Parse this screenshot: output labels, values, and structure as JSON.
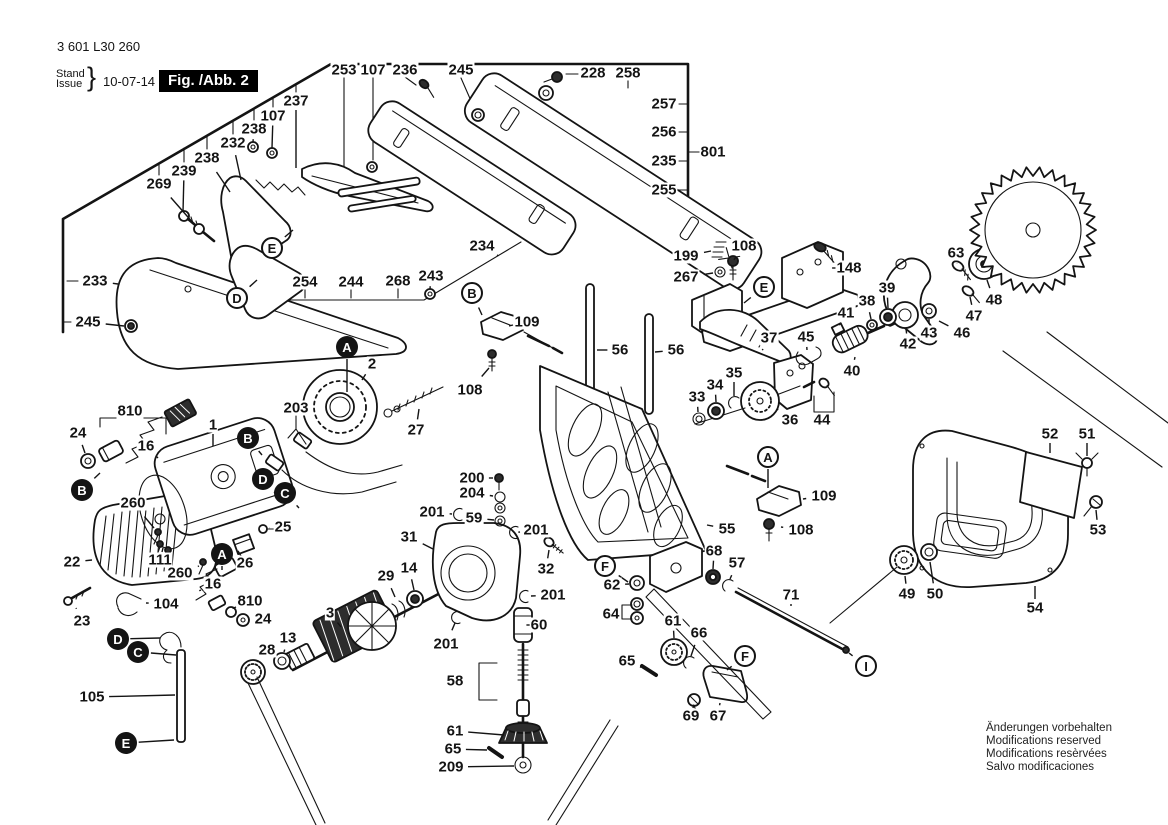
{
  "header": {
    "part_number": "3 601 L30 260",
    "stand_label": "Stand",
    "issue_label": "Issue",
    "brace": "}",
    "date": "10-07-14",
    "figure_label": "Fig. /Abb. 2"
  },
  "footer": {
    "lines": [
      "Änderungen vorbehalten",
      "Modifications reserved",
      "Modifications resèrvées",
      "Salvo modificaciones"
    ]
  },
  "colors": {
    "ink": "#141414",
    "paper": "#ffffff",
    "figure_box_bg": "#000000",
    "figure_box_text": "#ffffff"
  },
  "diagram": {
    "blade": {
      "cx": 1033,
      "cy": 230,
      "r_outer": 63,
      "r_inner": 54,
      "teeth": 30
    }
  },
  "part_labels": [
    {
      "t": "253",
      "x": 344,
      "y": 70
    },
    {
      "t": "107",
      "x": 373,
      "y": 70
    },
    {
      "t": "236",
      "x": 405,
      "y": 70
    },
    {
      "t": "245",
      "x": 461,
      "y": 70
    },
    {
      "t": "228",
      "x": 593,
      "y": 73
    },
    {
      "t": "258",
      "x": 628,
      "y": 73
    },
    {
      "t": "257",
      "x": 664,
      "y": 104
    },
    {
      "t": "256",
      "x": 664,
      "y": 132
    },
    {
      "t": "801",
      "x": 713,
      "y": 152
    },
    {
      "t": "235",
      "x": 664,
      "y": 161
    },
    {
      "t": "255",
      "x": 664,
      "y": 190
    },
    {
      "t": "237",
      "x": 296,
      "y": 101,
      "lx": 296,
      "ly": 168
    },
    {
      "t": "107",
      "x": 273,
      "y": 116,
      "lx": 272,
      "ly": 148
    },
    {
      "t": "238",
      "x": 254,
      "y": 129,
      "lx": 253,
      "ly": 142
    },
    {
      "t": "232",
      "x": 233,
      "y": 143,
      "lx": 241,
      "ly": 180
    },
    {
      "t": "238",
      "x": 207,
      "y": 158,
      "lx": 230,
      "ly": 192
    },
    {
      "t": "239",
      "x": 184,
      "y": 171,
      "lx": 183,
      "ly": 212
    },
    {
      "t": "269",
      "x": 159,
      "y": 184,
      "lx": 194,
      "ly": 224
    },
    {
      "t": "233",
      "x": 95,
      "y": 281,
      "lx": 118,
      "ly": 284
    },
    {
      "t": "245",
      "x": 88,
      "y": 322,
      "lx": 124,
      "ly": 326
    },
    {
      "t": "254",
      "x": 305,
      "y": 282
    },
    {
      "t": "244",
      "x": 351,
      "y": 282
    },
    {
      "t": "268",
      "x": 398,
      "y": 281
    },
    {
      "t": "243",
      "x": 431,
      "y": 276,
      "lx": 430,
      "ly": 289
    },
    {
      "t": "234",
      "x": 482,
      "y": 246,
      "lx": 497,
      "ly": 255
    },
    {
      "t": "109",
      "x": 527,
      "y": 322,
      "lx": 513,
      "ly": 325
    },
    {
      "t": "108",
      "x": 470,
      "y": 390,
      "lx": 489,
      "ly": 368
    },
    {
      "t": "56",
      "x": 620,
      "y": 350,
      "lx": 597,
      "ly": 350
    },
    {
      "t": "56",
      "x": 676,
      "y": 350,
      "lx": 655,
      "ly": 352
    },
    {
      "t": "199",
      "x": 686,
      "y": 256,
      "lx": 711,
      "ly": 251
    },
    {
      "t": "108",
      "x": 744,
      "y": 246,
      "lx": 736,
      "ly": 257
    },
    {
      "t": "267",
      "x": 686,
      "y": 277,
      "lx": 713,
      "ly": 273
    },
    {
      "t": "148",
      "x": 849,
      "y": 268,
      "lx": 845,
      "ly": 268
    },
    {
      "t": "63",
      "x": 956,
      "y": 253,
      "lx": 957,
      "ly": 263
    },
    {
      "t": "39",
      "x": 887,
      "y": 288,
      "lx": 888,
      "ly": 308
    },
    {
      "t": "38",
      "x": 867,
      "y": 301,
      "lx": 871,
      "ly": 319
    },
    {
      "t": "41",
      "x": 846,
      "y": 313,
      "lx": 840,
      "ly": 324
    },
    {
      "t": "48",
      "x": 994,
      "y": 300,
      "lx": 987,
      "ly": 280
    },
    {
      "t": "47",
      "x": 974,
      "y": 316,
      "lx": 970,
      "ly": 297
    },
    {
      "t": "46",
      "x": 962,
      "y": 333,
      "lx": 939,
      "ly": 321
    },
    {
      "t": "43",
      "x": 929,
      "y": 333,
      "lx": 929,
      "ly": 319
    },
    {
      "t": "42",
      "x": 908,
      "y": 344,
      "lx": 906,
      "ly": 329
    },
    {
      "t": "37",
      "x": 769,
      "y": 338,
      "lx": 763,
      "ly": 349
    },
    {
      "t": "45",
      "x": 806,
      "y": 337,
      "lx": 807,
      "ly": 350
    },
    {
      "t": "40",
      "x": 852,
      "y": 371,
      "lx": 855,
      "ly": 357
    },
    {
      "t": "35",
      "x": 734,
      "y": 373,
      "lx": 734,
      "ly": 396
    },
    {
      "t": "34",
      "x": 715,
      "y": 385,
      "lx": 716,
      "ly": 402
    },
    {
      "t": "33",
      "x": 697,
      "y": 397,
      "lx": 698,
      "ly": 412
    },
    {
      "t": "36",
      "x": 790,
      "y": 420,
      "lx": 777,
      "ly": 409
    },
    {
      "t": "44",
      "x": 822,
      "y": 420
    },
    {
      "t": "2",
      "x": 372,
      "y": 364,
      "lx": 362,
      "ly": 380
    },
    {
      "t": "203",
      "x": 296,
      "y": 408
    },
    {
      "t": "1",
      "x": 213,
      "y": 425,
      "lx": 213,
      "ly": 446
    },
    {
      "t": "27",
      "x": 416,
      "y": 430,
      "lx": 419,
      "ly": 409
    },
    {
      "t": "810",
      "x": 130,
      "y": 411
    },
    {
      "t": "24",
      "x": 78,
      "y": 433,
      "lx": 85,
      "ly": 453
    },
    {
      "t": "16",
      "x": 146,
      "y": 446,
      "lx": 158,
      "ly": 458
    },
    {
      "t": "260",
      "x": 133,
      "y": 503,
      "lx": 154,
      "ly": 528
    },
    {
      "t": "25",
      "x": 283,
      "y": 527,
      "lx": 270,
      "ly": 528
    },
    {
      "t": "26",
      "x": 245,
      "y": 563,
      "lx": 241,
      "ly": 556
    },
    {
      "t": "22",
      "x": 72,
      "y": 562,
      "lx": 92,
      "ly": 560
    },
    {
      "t": "111",
      "x": 160,
      "y": 560,
      "lx": 162,
      "ly": 552
    },
    {
      "t": "260",
      "x": 180,
      "y": 573,
      "lx": 199,
      "ly": 566
    },
    {
      "t": "23",
      "x": 82,
      "y": 621,
      "lx": 76,
      "ly": 608
    },
    {
      "t": "104",
      "x": 166,
      "y": 604,
      "lx": 146,
      "ly": 603
    },
    {
      "t": "16",
      "x": 213,
      "y": 584,
      "lx": 201,
      "ly": 590
    },
    {
      "t": "810",
      "x": 250,
      "y": 601,
      "lx": 236,
      "ly": 607
    },
    {
      "t": "24",
      "x": 263,
      "y": 619,
      "lx": 250,
      "ly": 620
    },
    {
      "t": "105",
      "x": 92,
      "y": 697,
      "lx": 175,
      "ly": 695
    },
    {
      "t": "28",
      "x": 267,
      "y": 650,
      "lx": 257,
      "ly": 662
    },
    {
      "t": "13",
      "x": 288,
      "y": 638,
      "lx": 284,
      "ly": 652
    },
    {
      "t": "3",
      "x": 330,
      "y": 613,
      "lx": 341,
      "ly": 627
    },
    {
      "t": "29",
      "x": 386,
      "y": 576,
      "lx": 395,
      "ly": 597
    },
    {
      "t": "14",
      "x": 409,
      "y": 568,
      "lx": 414,
      "ly": 590
    },
    {
      "t": "31",
      "x": 409,
      "y": 537,
      "lx": 433,
      "ly": 549
    },
    {
      "t": "200",
      "x": 472,
      "y": 478,
      "lx": 493,
      "ly": 478
    },
    {
      "t": "204",
      "x": 472,
      "y": 493,
      "lx": 493,
      "ly": 496
    },
    {
      "t": "201",
      "x": 432,
      "y": 512,
      "lx": 452,
      "ly": 514
    },
    {
      "t": "59",
      "x": 474,
      "y": 518,
      "lx": 494,
      "ly": 520
    },
    {
      "t": "201",
      "x": 536,
      "y": 530,
      "lx": 520,
      "ly": 532
    },
    {
      "t": "32",
      "x": 546,
      "y": 569,
      "lx": 549,
      "ly": 550
    },
    {
      "t": "201",
      "x": 553,
      "y": 595,
      "lx": 531,
      "ly": 596
    },
    {
      "t": "201",
      "x": 446,
      "y": 644,
      "lx": 455,
      "ly": 623
    },
    {
      "t": "60",
      "x": 539,
      "y": 625,
      "lx": 533,
      "ly": 625
    },
    {
      "t": "58",
      "x": 455,
      "y": 681
    },
    {
      "t": "61",
      "x": 455,
      "y": 731,
      "lx": 504,
      "ly": 735
    },
    {
      "t": "65",
      "x": 453,
      "y": 749,
      "lx": 487,
      "ly": 750
    },
    {
      "t": "209",
      "x": 451,
      "y": 767,
      "lx": 514,
      "ly": 766
    },
    {
      "t": "55",
      "x": 727,
      "y": 529,
      "lx": 707,
      "ly": 525
    },
    {
      "t": "68",
      "x": 714,
      "y": 551,
      "lx": 713,
      "ly": 569
    },
    {
      "t": "57",
      "x": 737,
      "y": 563,
      "lx": 730,
      "ly": 579
    },
    {
      "t": "109",
      "x": 824,
      "y": 496,
      "lx": 803,
      "ly": 499
    },
    {
      "t": "108",
      "x": 801,
      "y": 530,
      "lx": 781,
      "ly": 527
    },
    {
      "t": "62",
      "x": 612,
      "y": 585,
      "lx": 629,
      "ly": 584
    },
    {
      "t": "64",
      "x": 611,
      "y": 614
    },
    {
      "t": "61",
      "x": 673,
      "y": 621,
      "lx": 674,
      "ly": 638
    },
    {
      "t": "66",
      "x": 699,
      "y": 633,
      "lx": 691,
      "ly": 656
    },
    {
      "t": "65",
      "x": 627,
      "y": 661,
      "lx": 640,
      "ly": 667
    },
    {
      "t": "69",
      "x": 691,
      "y": 716,
      "lx": 693,
      "ly": 708
    },
    {
      "t": "67",
      "x": 718,
      "y": 716,
      "lx": 720,
      "ly": 703
    },
    {
      "t": "71",
      "x": 791,
      "y": 595,
      "lx": 791,
      "ly": 606
    },
    {
      "t": "52",
      "x": 1050,
      "y": 434,
      "lx": 1050,
      "ly": 453
    },
    {
      "t": "51",
      "x": 1087,
      "y": 434,
      "lx": 1087,
      "ly": 456
    },
    {
      "t": "53",
      "x": 1098,
      "y": 530,
      "lx": 1096,
      "ly": 510
    },
    {
      "t": "54",
      "x": 1035,
      "y": 608,
      "lx": 1035,
      "ly": 586
    },
    {
      "t": "49",
      "x": 907,
      "y": 594,
      "lx": 905,
      "ly": 576
    },
    {
      "t": "50",
      "x": 935,
      "y": 594,
      "lx": 930,
      "ly": 562
    }
  ],
  "ref_letters": [
    {
      "ch": "E",
      "x": 272,
      "y": 248,
      "filled": false,
      "lx": 293,
      "ly": 230
    },
    {
      "ch": "D",
      "x": 237,
      "y": 298,
      "filled": false,
      "lx": 257,
      "ly": 280
    },
    {
      "ch": "B",
      "x": 472,
      "y": 293,
      "filled": false,
      "lx": 482,
      "ly": 315
    },
    {
      "ch": "E",
      "x": 764,
      "y": 287,
      "filled": false,
      "lx": 744,
      "ly": 303
    },
    {
      "ch": "A",
      "x": 768,
      "y": 457,
      "filled": false,
      "lx": 768,
      "ly": 488
    },
    {
      "ch": "F",
      "x": 605,
      "y": 566,
      "filled": false,
      "lx": 628,
      "ly": 582
    },
    {
      "ch": "F",
      "x": 745,
      "y": 656,
      "filled": false,
      "lx": 727,
      "ly": 670
    },
    {
      "ch": "I",
      "x": 866,
      "y": 666,
      "filled": false,
      "lx": 849,
      "ly": 653
    },
    {
      "ch": "A",
      "x": 347,
      "y": 347,
      "filled": true,
      "lx": 347,
      "ly": 392
    },
    {
      "ch": "B",
      "x": 248,
      "y": 438,
      "filled": true,
      "lx": 262,
      "ly": 455
    },
    {
      "ch": "B",
      "x": 82,
      "y": 490,
      "filled": true,
      "lx": 100,
      "ly": 473
    },
    {
      "ch": "D",
      "x": 263,
      "y": 479,
      "filled": true,
      "lx": 276,
      "ly": 494
    },
    {
      "ch": "C",
      "x": 285,
      "y": 493,
      "filled": true,
      "lx": 299,
      "ly": 508
    },
    {
      "ch": "A",
      "x": 222,
      "y": 554,
      "filled": true,
      "lx": 222,
      "ly": 570
    },
    {
      "ch": "D",
      "x": 118,
      "y": 639,
      "filled": true,
      "lx": 160,
      "ly": 638
    },
    {
      "ch": "C",
      "x": 138,
      "y": 652,
      "filled": true,
      "lx": 176,
      "ly": 655
    },
    {
      "ch": "E",
      "x": 126,
      "y": 743,
      "filled": true,
      "lx": 174,
      "ly": 740
    }
  ]
}
